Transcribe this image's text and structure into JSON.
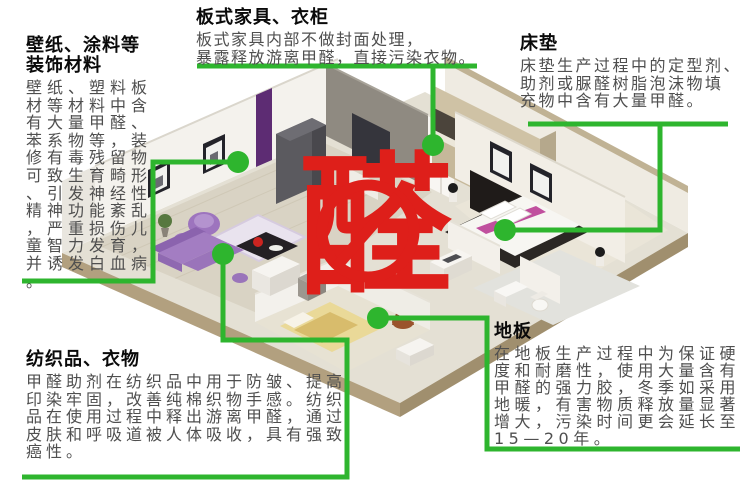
{
  "center": {
    "character": "醛",
    "color": "#de1f1a",
    "sign": "prohibition-circle-slash"
  },
  "accent": {
    "green": "#2eb52e"
  },
  "notes": {
    "wallpaper": {
      "title": "壁纸、涂料等",
      "title2": "装饰材料",
      "lines": [
        "壁纸、塑料板",
        "材等材料中含",
        "有大量甲醛、",
        "苯系物等，装",
        "修有毒残留物",
        "可致生育畸形",
        "、引发神经性",
        "精神功能紊乱",
        "，严重损伤儿",
        "童智力发育，",
        "并诱发白血病",
        "。"
      ]
    },
    "furniture": {
      "title": "板式家具、衣柜",
      "lines": [
        "板式家具内部不做封面处理，",
        "暴露释放游离甲醛，直接污染衣物。"
      ]
    },
    "mattress": {
      "title": "床垫",
      "lines": [
        "床垫生产过程中的定型剂、",
        "助剂或脲醛树脂泡沫物填",
        "充物中含有大量甲醛。"
      ]
    },
    "textile": {
      "title": "纺织品、衣物",
      "lines": [
        "甲醛助剂在纺织品中用于防皱、提高",
        "印染牢固，改善纯棉织物手感。纺织",
        "品在使用过程中释出游离甲醛，通过",
        "皮肤和呼吸道被人体吸收，具有强致",
        "癌性。"
      ]
    },
    "floor": {
      "title": "地板",
      "lines": [
        "在地板生产过程中为保证硬",
        "度和耐磨性，使用大量含有",
        "甲醛的强力胶，冬季如采用",
        "地暖，有害物质释放量显著",
        "增大，污染时间更会延长至",
        "15—20年。"
      ]
    }
  }
}
